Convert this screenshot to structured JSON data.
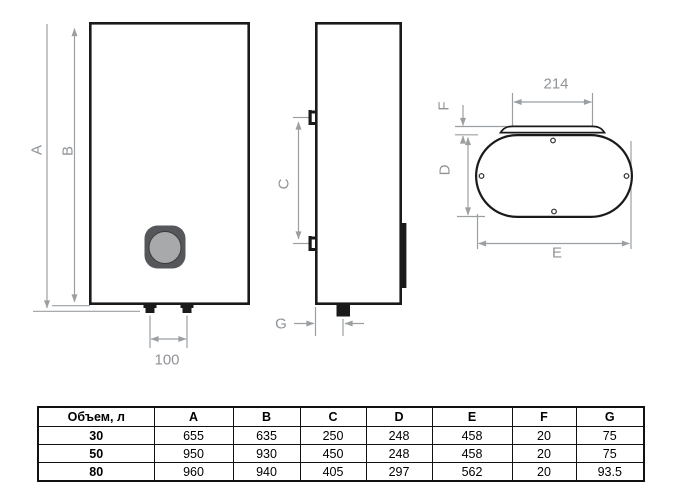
{
  "diagram": {
    "labels": {
      "A": "A",
      "B": "B",
      "C": "C",
      "D": "D",
      "E": "E",
      "F": "F",
      "G": "G"
    },
    "measurements": {
      "anchor_spacing": "100",
      "flange_width": "214"
    },
    "colors": {
      "outline": "#1a1a1a",
      "dimension_lines": "#9b9fa2",
      "knob_outer": "#55575b",
      "knob_inner": "#a8a9ab"
    }
  },
  "table": {
    "volume_header": "Объем, л",
    "dim_headers": [
      "A",
      "B",
      "C",
      "D",
      "E",
      "F",
      "G"
    ],
    "rows": [
      {
        "volume": "30",
        "A": "655",
        "B": "635",
        "C": "250",
        "D": "248",
        "E": "458",
        "F": "20",
        "G": "75"
      },
      {
        "volume": "50",
        "A": "950",
        "B": "930",
        "C": "450",
        "D": "248",
        "E": "458",
        "F": "20",
        "G": "75"
      },
      {
        "volume": "80",
        "A": "960",
        "B": "940",
        "C": "405",
        "D": "297",
        "E": "562",
        "F": "20",
        "G": "93.5"
      }
    ]
  }
}
